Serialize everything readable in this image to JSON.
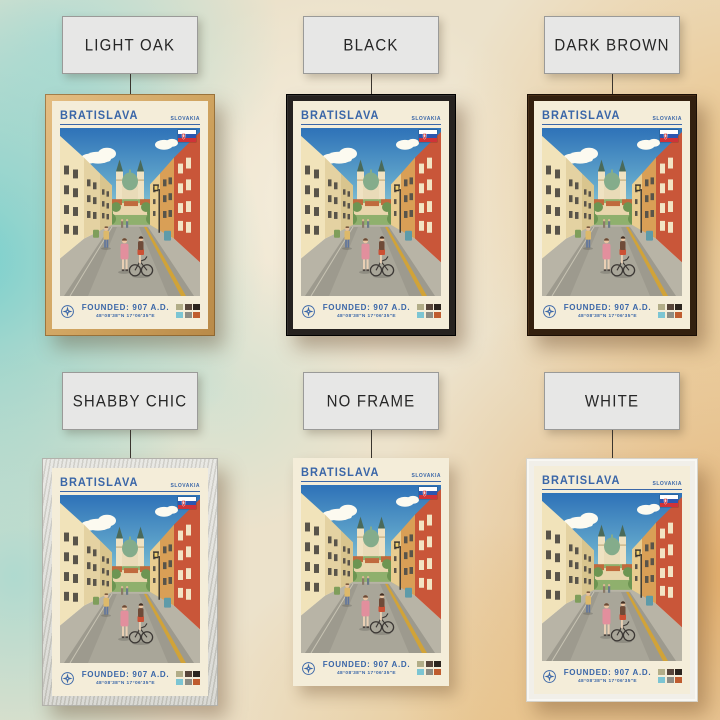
{
  "scene": {
    "description": "Bratislava travel poster mockup showing six frame finish options hanging on a watercolor wall",
    "wall_colors": {
      "teal": "#6ccece",
      "cream": "#ece2cb",
      "orange": "#e2a355"
    }
  },
  "poster": {
    "title": "BRATISLAVA",
    "country": "SLOVAKIA",
    "founded": "FOUNDED: 907 A.D.",
    "coordinates": "48°08'38\"N 17°06'35\"E",
    "accent_color": "#3a66a8",
    "paper_color": "#f4edd9",
    "flag_icon": "slovakia-flag",
    "compass_icon": "compass-icon",
    "swatch_colors": [
      "#b2ad88",
      "#57453a",
      "#2b241e",
      "#7cc5d3",
      "#8d8d85",
      "#bf5c2f"
    ]
  },
  "frame_options": [
    {
      "id": "light-oak",
      "label": "LIGHT OAK",
      "color": "#d2a666"
    },
    {
      "id": "black",
      "label": "BLACK",
      "color": "#262220"
    },
    {
      "id": "dark-brown",
      "label": "DARK BROWN",
      "color": "#33200f"
    },
    {
      "id": "shabby-chic",
      "label": "SHABBY CHIC",
      "color": "#d9d8d3"
    },
    {
      "id": "no-frame",
      "label": "NO FRAME",
      "color": "none"
    },
    {
      "id": "white",
      "label": "WHITE",
      "color": "#f1efe9"
    }
  ]
}
